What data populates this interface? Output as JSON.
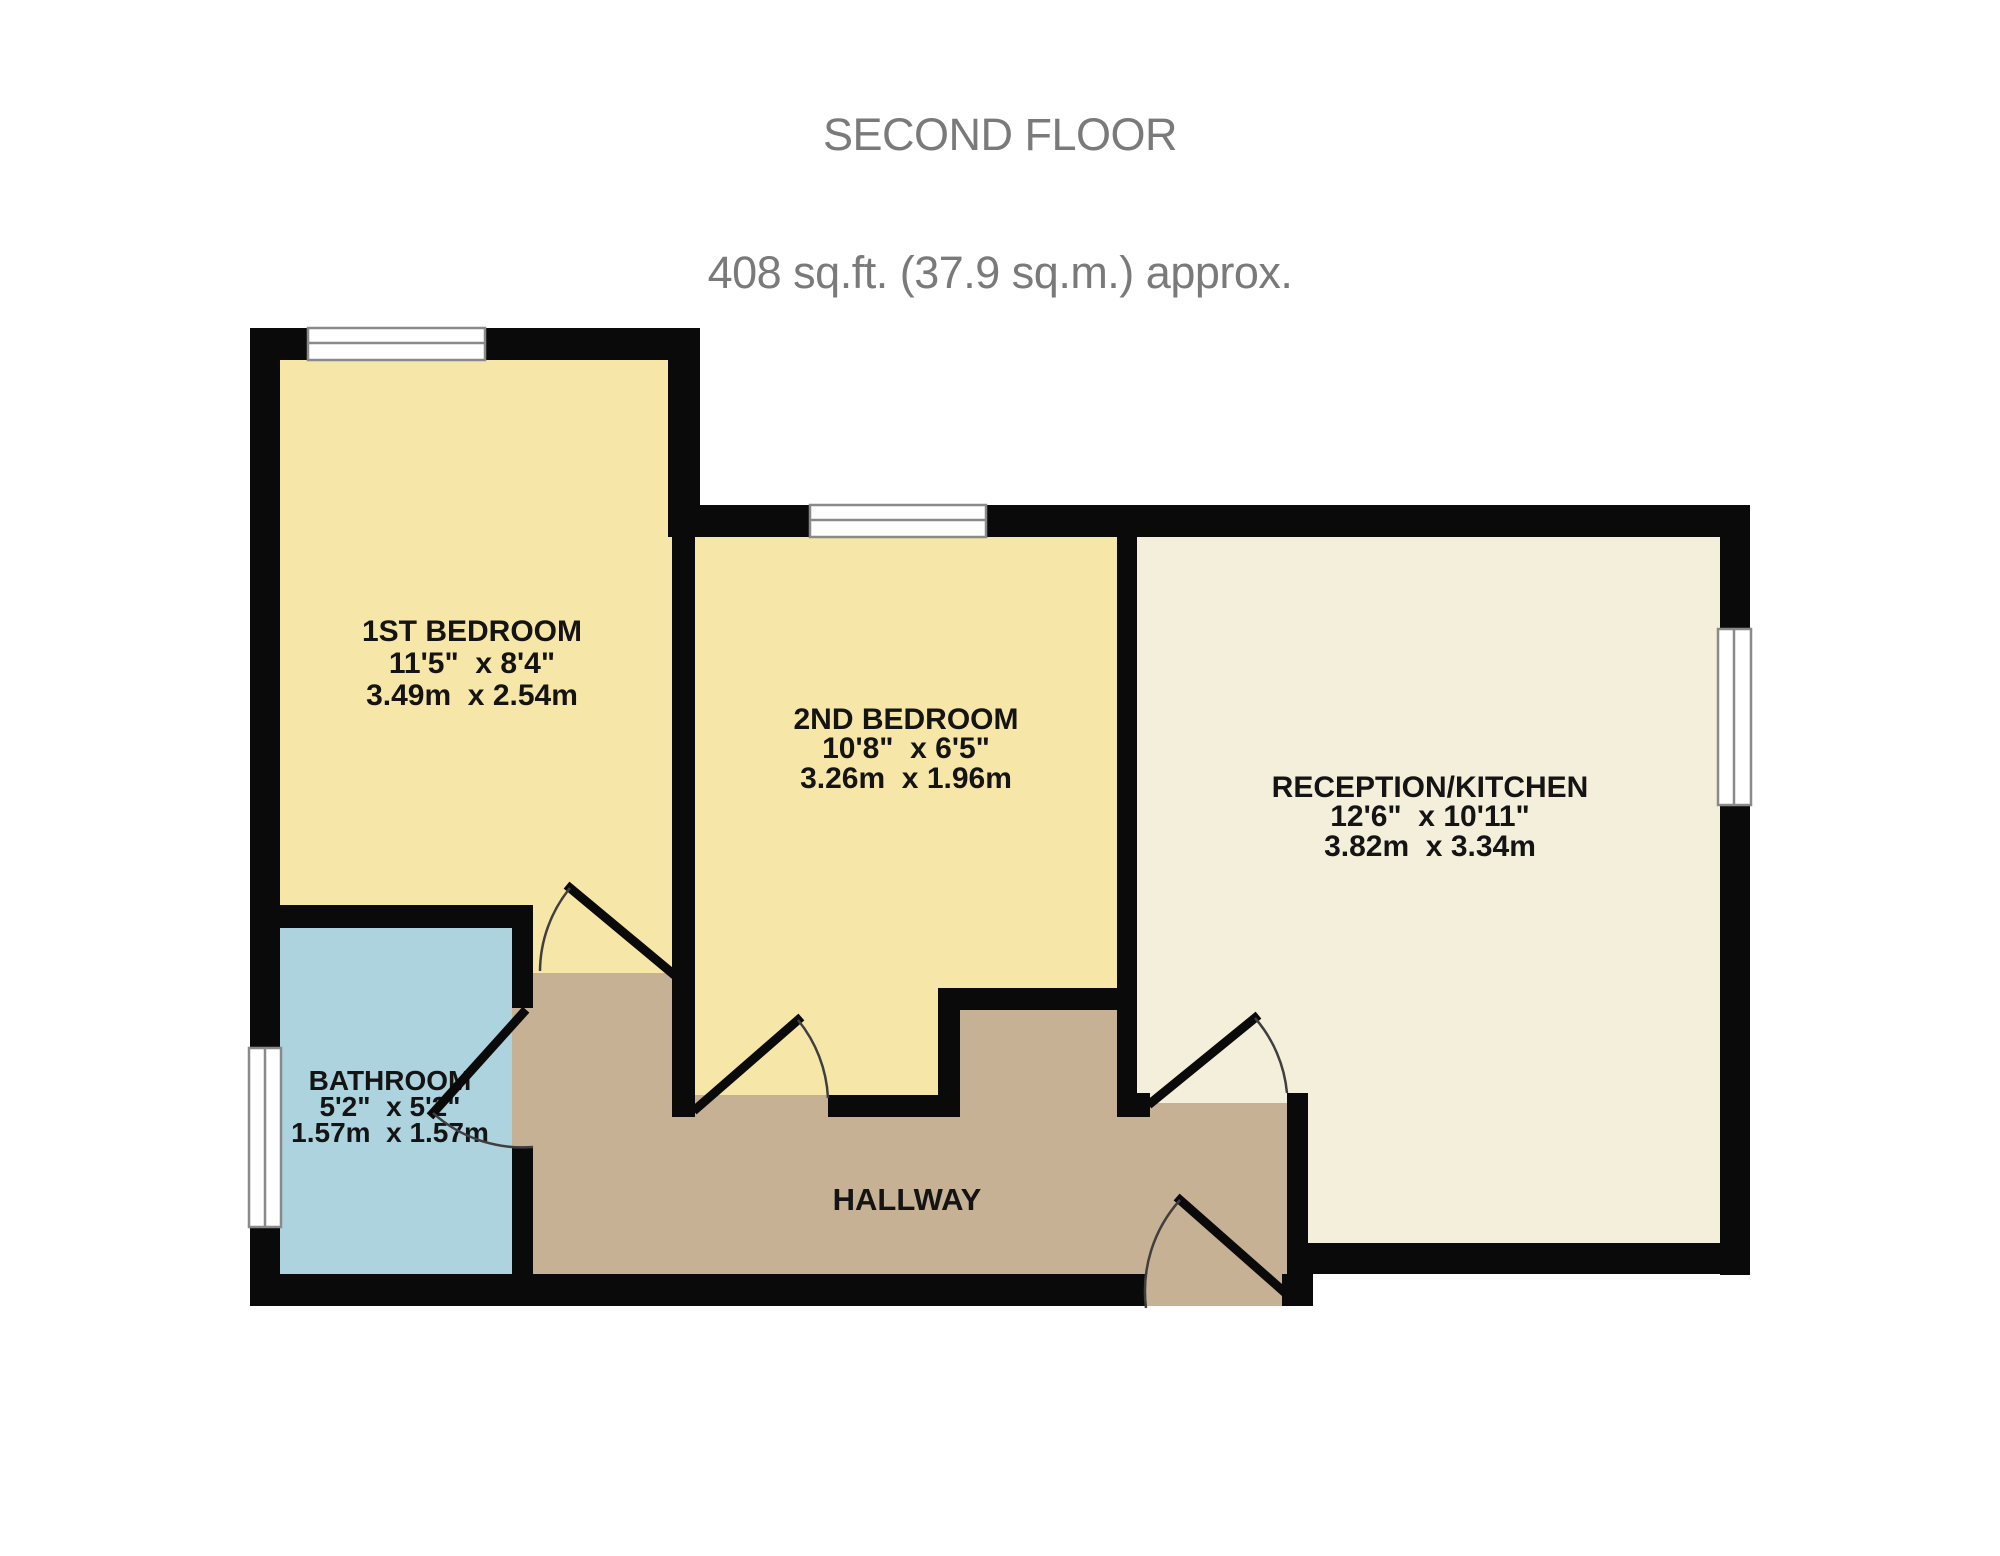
{
  "title": {
    "line1": "SECOND FLOOR",
    "line2": "408 sq.ft. (37.9 sq.m.) approx."
  },
  "rooms": [
    {
      "name": "1ST BEDROOM",
      "size_imperial": "11'5\"  x 8'4\"",
      "size_metric": "3.49m  x 2.54m",
      "fill": "#F6E6A7"
    },
    {
      "name": "2ND BEDROOM",
      "size_imperial": "10'8\"  x 6'5\"",
      "size_metric": "3.26m  x 1.96m",
      "fill": "#F6E6A7"
    },
    {
      "name": "RECEPTION/KITCHEN",
      "size_imperial": "12'6\"  x 10'11\"",
      "size_metric": "3.82m  x 3.34m",
      "fill": "#F4EFDA"
    },
    {
      "name": "BATHROOM",
      "size_imperial": "5'2\"  x 5'2\"",
      "size_metric": "1.57m  x 1.57m",
      "fill": "#ACD3DE"
    },
    {
      "name": "HALLWAY",
      "fill": "#C6B194"
    }
  ],
  "colors": {
    "wall": "#0A0A0A",
    "window_frame": "#8A8A8A",
    "door_arc": "#3F3F3F",
    "title_text": "#7A7A7A",
    "label_text": "#141414",
    "background": "#FFFFFF"
  }
}
